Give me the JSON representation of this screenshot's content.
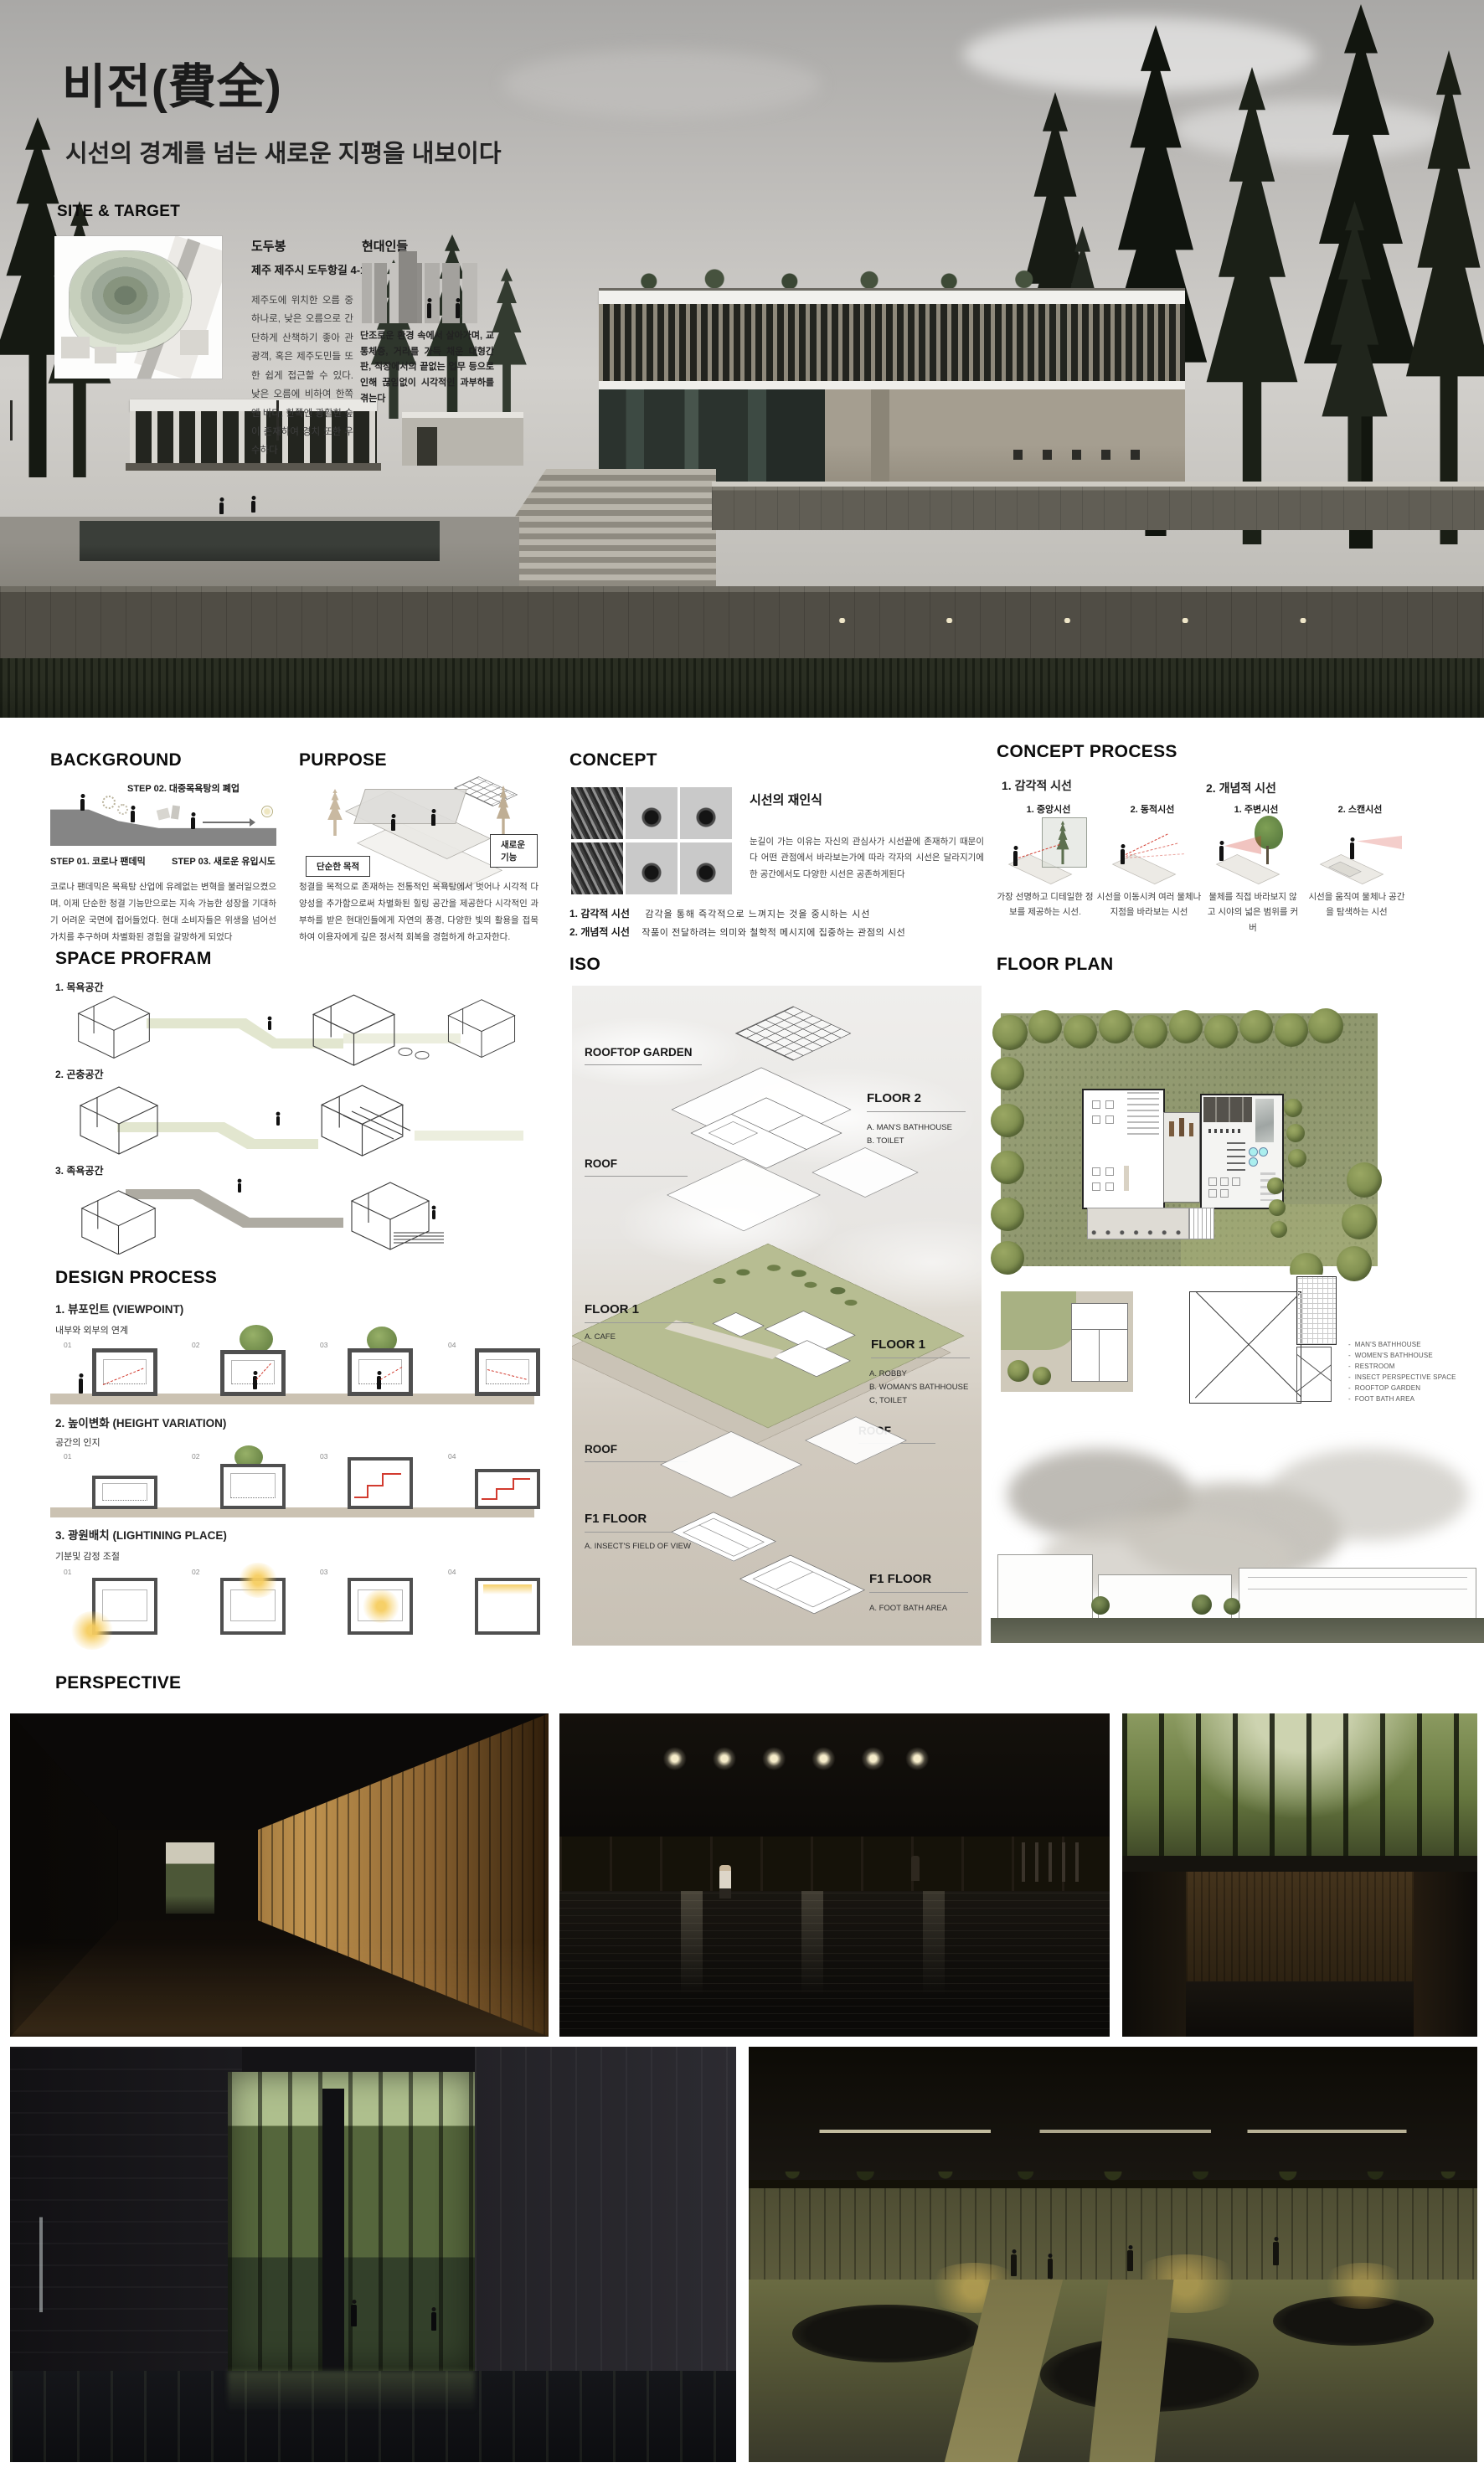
{
  "title": {
    "main": "비전(費全)",
    "subtitle": "시선의 경계를 넘는 새로운 지평을 내보이다"
  },
  "site_target": {
    "heading": "SITE & TARGET",
    "site_name": "도두봉",
    "site_address": "제주 제주시 도두항길 4-17",
    "site_desc": "제주도에 위치한 오름 중 하나로, 낮은 오름으로 간단하게 산책하기 좋아 관광객, 혹은 제주도민들 또한 쉽게 접근할 수 있다. 낮은 오름에 비하여 한쪽엔 바다, 한쪽엔 광활한 숲이 존재하여 경치 또한 우수하다",
    "target_name": "현대인들",
    "target_desc": "단조로운 환경 속에서 살아가며, 교통체증, 거리를 가득 채운 대형간판, 직장에서의 끝없는 업무 등으로 인해 끊임없이 시각적인 과부하를 겪는다"
  },
  "background": {
    "heading": "BACKGROUND",
    "step1": "STEP 01. 코로나 팬데믹",
    "step2": "STEP 02. 대중목욕탕의 폐업",
    "step3": "STEP 03.  새로운 유입시도",
    "desc": "코로나 팬데믹은 목욕탕 산업에 유례없는 변혁을 불러일으켰으며, 이제 단순한 청결 기능만으로는 지속 가능한 성장을 기대하기 어려운 국면에 접어들었다. 현대 소비자들은 위생을 넘어선 가치를 추구하며 차별화된 경험을 갈망하게 되었다"
  },
  "purpose": {
    "heading": "PURPOSE",
    "label_old": "단순한 목적",
    "label_new": "새로운 기능",
    "desc": "청결을 목적으로 존재하는 전통적인 목욕탕에서 벗어나 시각적 다양성을 추가함으로써 차별화된 힐링 공간을 제공한다 시각적인 과부하를 받은 현대인들에게 자연의 풍경, 다양한 빛의 활용을 접목하여 이용자에게 깊은 정서적 회복을 경험하게 하고자한다."
  },
  "concept": {
    "heading": "CONCEPT",
    "subheading": "시선의 재인식",
    "desc": "눈길이 가는 이유는 자신의 관심사가 시선끝에 존재하기 때문이다 어떤 관점에서 바라보는가에 따라 각자의 시선은 달라지기에 한 공간에서도 다양한 시선은 공존하게된다",
    "item1_label": "1. 감각적 시선",
    "item1_desc": "감각을 통해 즉각적으로 느껴지는 것을 중시하는 시선",
    "item2_label": "2. 개념적 시선",
    "item2_desc": "작품이 전달하려는 의미와 철학적 메시지에 집중하는 관점의 시선"
  },
  "concept_process": {
    "heading": "CONCEPT PROCESS",
    "group1": "1. 감각적 시선",
    "group2": "2. 개념적 시선",
    "cols": [
      {
        "label": "1. 중앙시선",
        "desc": "가장 선명하고 디테일한 정보를 제공하는 시선."
      },
      {
        "label": "2. 동적시선",
        "desc": "시선을 이동시켜 여러 물체나 지점을 바라보는 시선"
      },
      {
        "label": "1. 주변시선",
        "desc": "물체를 직접 바라보지 않고 시야의 넓은 범위를 커버"
      },
      {
        "label": "2. 스캔시선",
        "desc": "시선을 움직여 물체나 공간을 탐색하는 시선"
      }
    ]
  },
  "space_program": {
    "heading": "SPACE PROFRAM",
    "item1": "1. 목욕공간",
    "item2": "2. 곤충공간",
    "item3": "3. 족욕공간"
  },
  "design_process": {
    "heading": "DESIGN PROCESS",
    "frames": [
      "01",
      "02",
      "03",
      "04"
    ],
    "row1_label": "1.  뷰포인트 (VIEWPOINT)",
    "row1_sub": "내부와 외부의 연계",
    "row2_label": "2. 높이변화 (HEIGHT VARIATION)",
    "row2_sub": "공간의 인지",
    "row3_label": "3. 광원배치 (LIGHTINING PLACE)",
    "row3_sub": "기분및  감정 조절"
  },
  "iso": {
    "heading": "ISO",
    "rooftop_garden": "ROOFTOP GARDEN",
    "floor2_title": "FLOOR 2",
    "floor2_a": "A. MAN'S BATHHOUSE",
    "floor2_b": "B. TOILET",
    "roof": "ROOF",
    "floor1_left_title": "FLOOR 1",
    "floor1_left_a": "A. CAFE",
    "floor1_right_title": "FLOOR 1",
    "floor1_right_a": "A. ROBBY",
    "floor1_right_b": "B. WOMAN'S BATHHOUSE",
    "floor1_right_c": "C, TOILET",
    "f1_left_title": "F1 FLOOR",
    "f1_left_a": "A. INSECT'S FIELD OF VIEW",
    "f1_right_title": "F1 FLOOR",
    "f1_right_a": "A. FOOT BATH AREA"
  },
  "floor_plan": {
    "heading": "FLOOR PLAN",
    "bullet": "-",
    "legend": [
      "MAN'S BATHHOUSE",
      "WOMEN'S BATHHOUSE",
      "RESTROOM",
      "INSECT PERSPECTIVE SPACE",
      "ROOFTOP GARDEN",
      "FOOT BATH AREA"
    ]
  },
  "perspective": {
    "heading": "PERSPECTIVE"
  },
  "colors": {
    "accent_red": "#d23b2f",
    "site_grass_green": "#9aa178",
    "iso_plate_green": "#b7bd92",
    "glow_yellow": "#f5d98b",
    "hero_sky_gray": "#c2c0bd",
    "forest_dark": "#161a13"
  }
}
